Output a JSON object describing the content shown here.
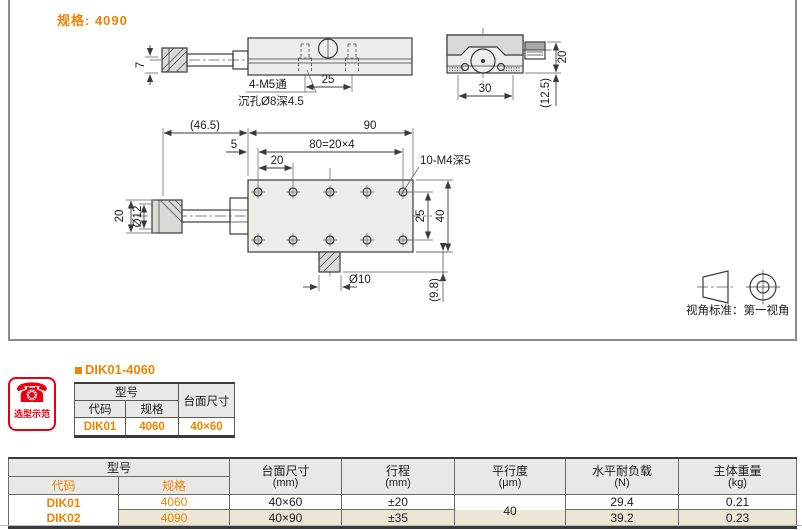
{
  "colors": {
    "accent_orange": "#f08300",
    "accent_red": "#e60012",
    "row_highlight": "#ebe7d4",
    "header_bg": "#e8e8e6"
  },
  "drawing": {
    "spec_label": "规格: 4090",
    "view_note": "视角标准：第一视角",
    "dims": {
      "side_height": "7",
      "side_thread": "4-M5通",
      "side_counterbore": "沉孔Ø8深4.5",
      "side_pitch": "25",
      "end_width": "30",
      "end_height": "20",
      "end_offset": "(12.5)",
      "plan_knob_len": "(46.5)",
      "plan_body_len": "90",
      "plan_edge": "5",
      "plan_pitch_total": "80=20×4",
      "plan_pitch": "20",
      "plan_thread": "10-M4深5",
      "plan_knob_dia": "Ø12",
      "plan_knob_h": "20",
      "plan_row_pitch": "25",
      "plan_body_w": "40",
      "plan_lock_dia": "Ø10",
      "plan_lock_len": "(9.8)"
    }
  },
  "selection_badge": {
    "phone_icon": "☎",
    "caption": "选型示范"
  },
  "example": {
    "title": "DIK01-4060",
    "table": {
      "header_model": "型号",
      "header_code": "代码",
      "header_spec": "规格",
      "header_size": "台面尺寸",
      "row": {
        "code": "DIK01",
        "spec": "4060",
        "size": "40×60"
      }
    }
  },
  "spec_table": {
    "headers": {
      "model": "型号",
      "code": "代码",
      "spec": "规格",
      "size": "台面尺寸",
      "size_unit": "(mm)",
      "travel": "行程",
      "travel_unit": "(mm)",
      "parallelism": "平行度",
      "parallelism_unit": "(μm)",
      "load": "水平耐负载",
      "load_unit": "(N)",
      "weight": "主体重量",
      "weight_unit": "(kg)"
    },
    "parallelism_value": "40",
    "rows": [
      {
        "code": "DIK01",
        "spec": "4060",
        "size": "40×60",
        "travel": "±20",
        "load": "29.4",
        "weight": "0.21"
      },
      {
        "code": "DIK02",
        "spec": "4090",
        "size": "40×90",
        "travel": "±35",
        "load": "39.2",
        "weight": "0.23"
      }
    ]
  }
}
